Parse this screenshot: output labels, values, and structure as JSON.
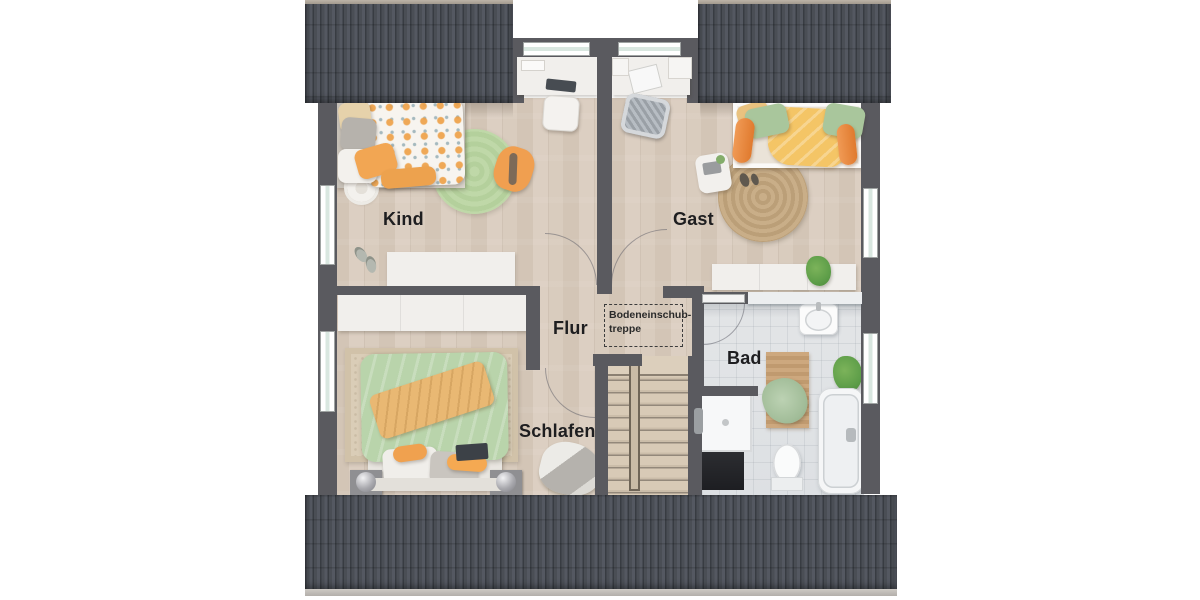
{
  "floorplan": {
    "type": "attic-floor-plan",
    "rooms": [
      {
        "id": "kind",
        "label": "Kind"
      },
      {
        "id": "gast",
        "label": "Gast"
      },
      {
        "id": "flur",
        "label": "Flur"
      },
      {
        "id": "schlafen",
        "label": "Schlafen"
      },
      {
        "id": "bad",
        "label": "Bad"
      }
    ],
    "annotation": {
      "line1": "Bodeneinschub-",
      "line2": "treppe"
    },
    "colors": {
      "roof": "#474b52",
      "roof_ridge": "#b5aca1",
      "wall": "#5a5a5f",
      "wood_floor": "#d6c9bb",
      "tile_floor": "#e0e2e4",
      "stair_wood": "#cfc1ae",
      "accent_orange": "#efa050",
      "accent_green": "#b9d3ab",
      "accent_yellow": "#f3c566",
      "jute": "#c4a984",
      "label_text": "#1e1e20"
    }
  }
}
